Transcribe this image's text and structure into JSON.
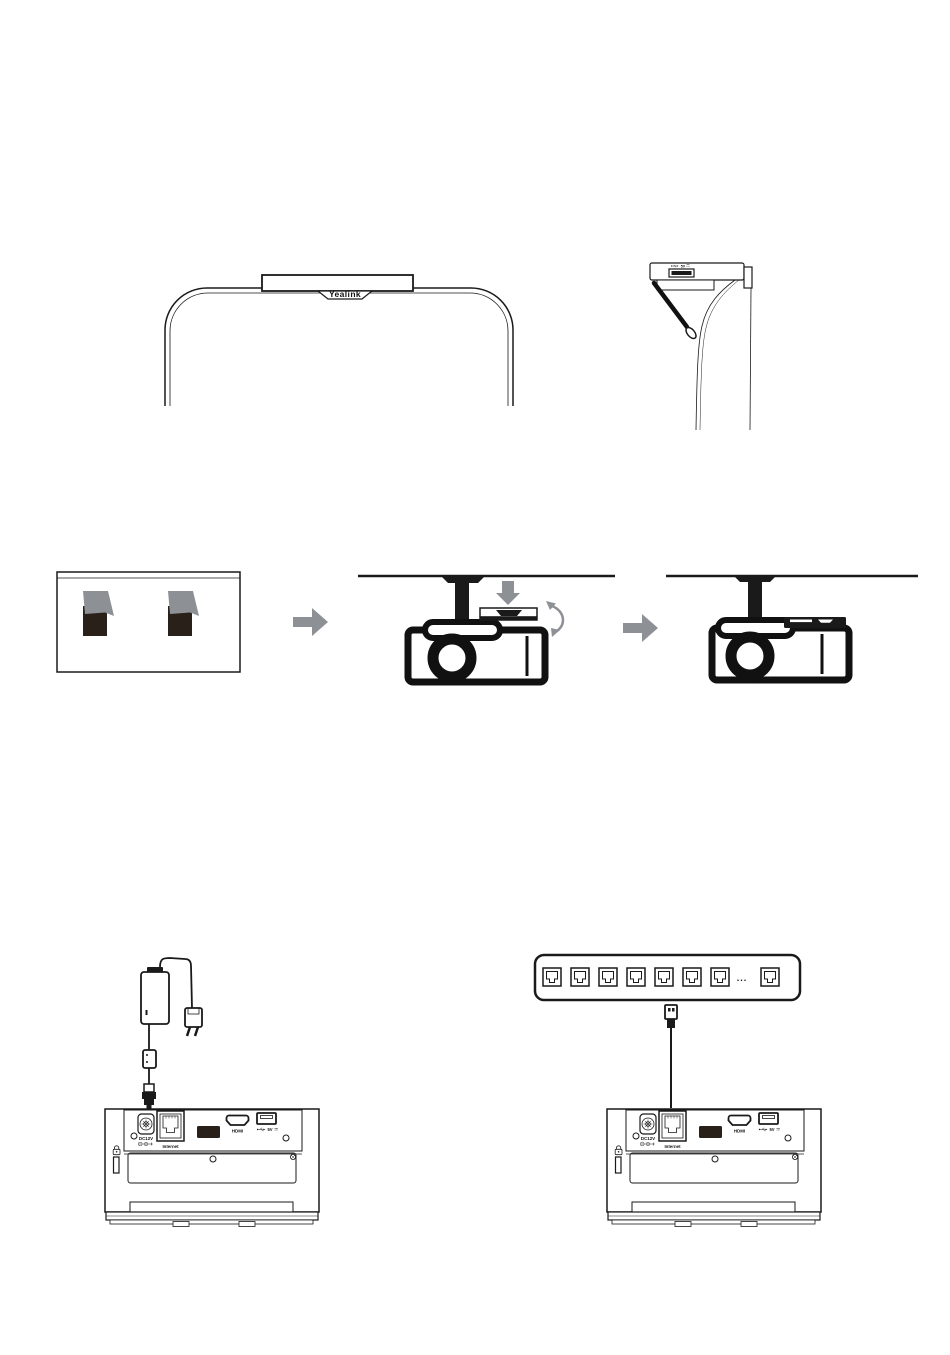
{
  "page": {
    "background": "#ffffff",
    "width": 950,
    "height": 1355
  },
  "colors": {
    "line_art": "#1a1a1a",
    "arrow_gray": "#8d9196",
    "adhesive_strip_dark": "#292019",
    "adhesive_strip_cover_gray": "#8d9196"
  },
  "labels": {
    "brand": "Yealink",
    "side_usb": "5V",
    "dc": "DC12V",
    "ethernet": "Internet",
    "hdmi": "HDMI",
    "usb": "5V",
    "switch_ellipsis": "..."
  },
  "icons": {
    "usb": "usb-trident-icon",
    "lock": "padlock-icon",
    "polarity": "dc-polarity-icon",
    "arrow_right": "block-arrow-right",
    "arrow_down": "block-arrow-down",
    "rotate": "curved-rotate-arrow"
  }
}
